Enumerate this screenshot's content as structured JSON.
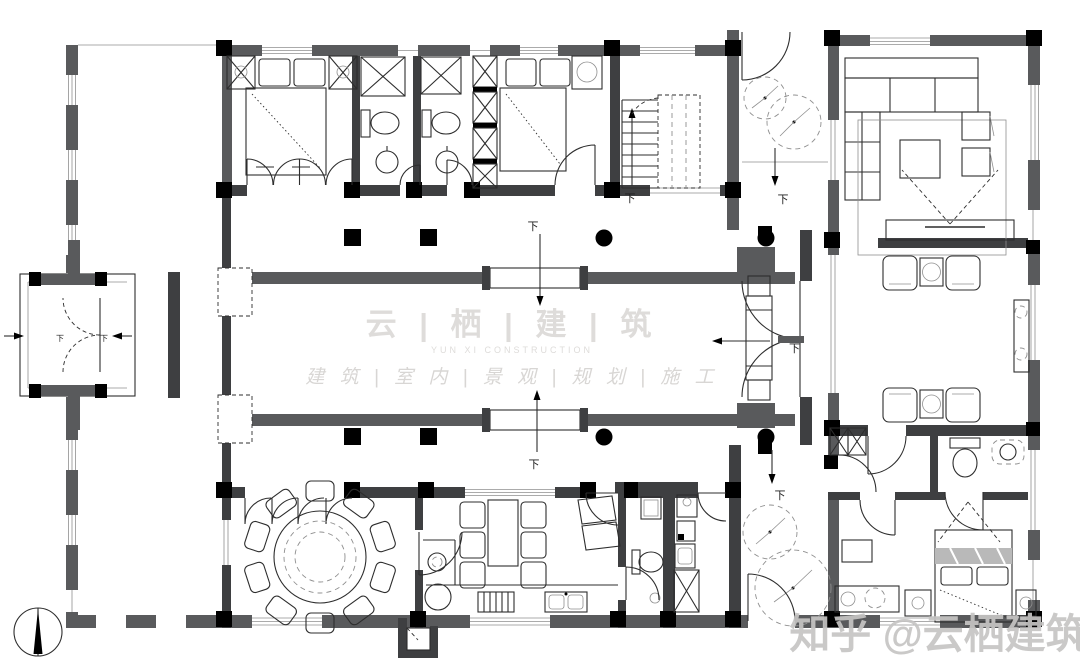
{
  "meta": {
    "type": "architectural-floor-plan",
    "subject": "courtyard-residence-ground-floor"
  },
  "watermark": {
    "brand": "云 | 栖 | 建 | 筑",
    "subtitle": "YUN XI CONSTRUCTION",
    "services": "建 筑 | 室 内 | 景 观 | 规 划 | 施 工",
    "credit": "知乎 @云栖建筑"
  },
  "labels": {
    "step": "下"
  },
  "colors": {
    "background": "#ffffff",
    "outer_wall": "#595a5c",
    "inner_wall": "#3e3f41",
    "column": "#000000",
    "line": "#2d2d2d",
    "light_line": "#8f8f8f",
    "watermark_text": "#dedcda",
    "credit_text": "#c6c5c4"
  },
  "compass": {
    "type": "north-arrow"
  }
}
